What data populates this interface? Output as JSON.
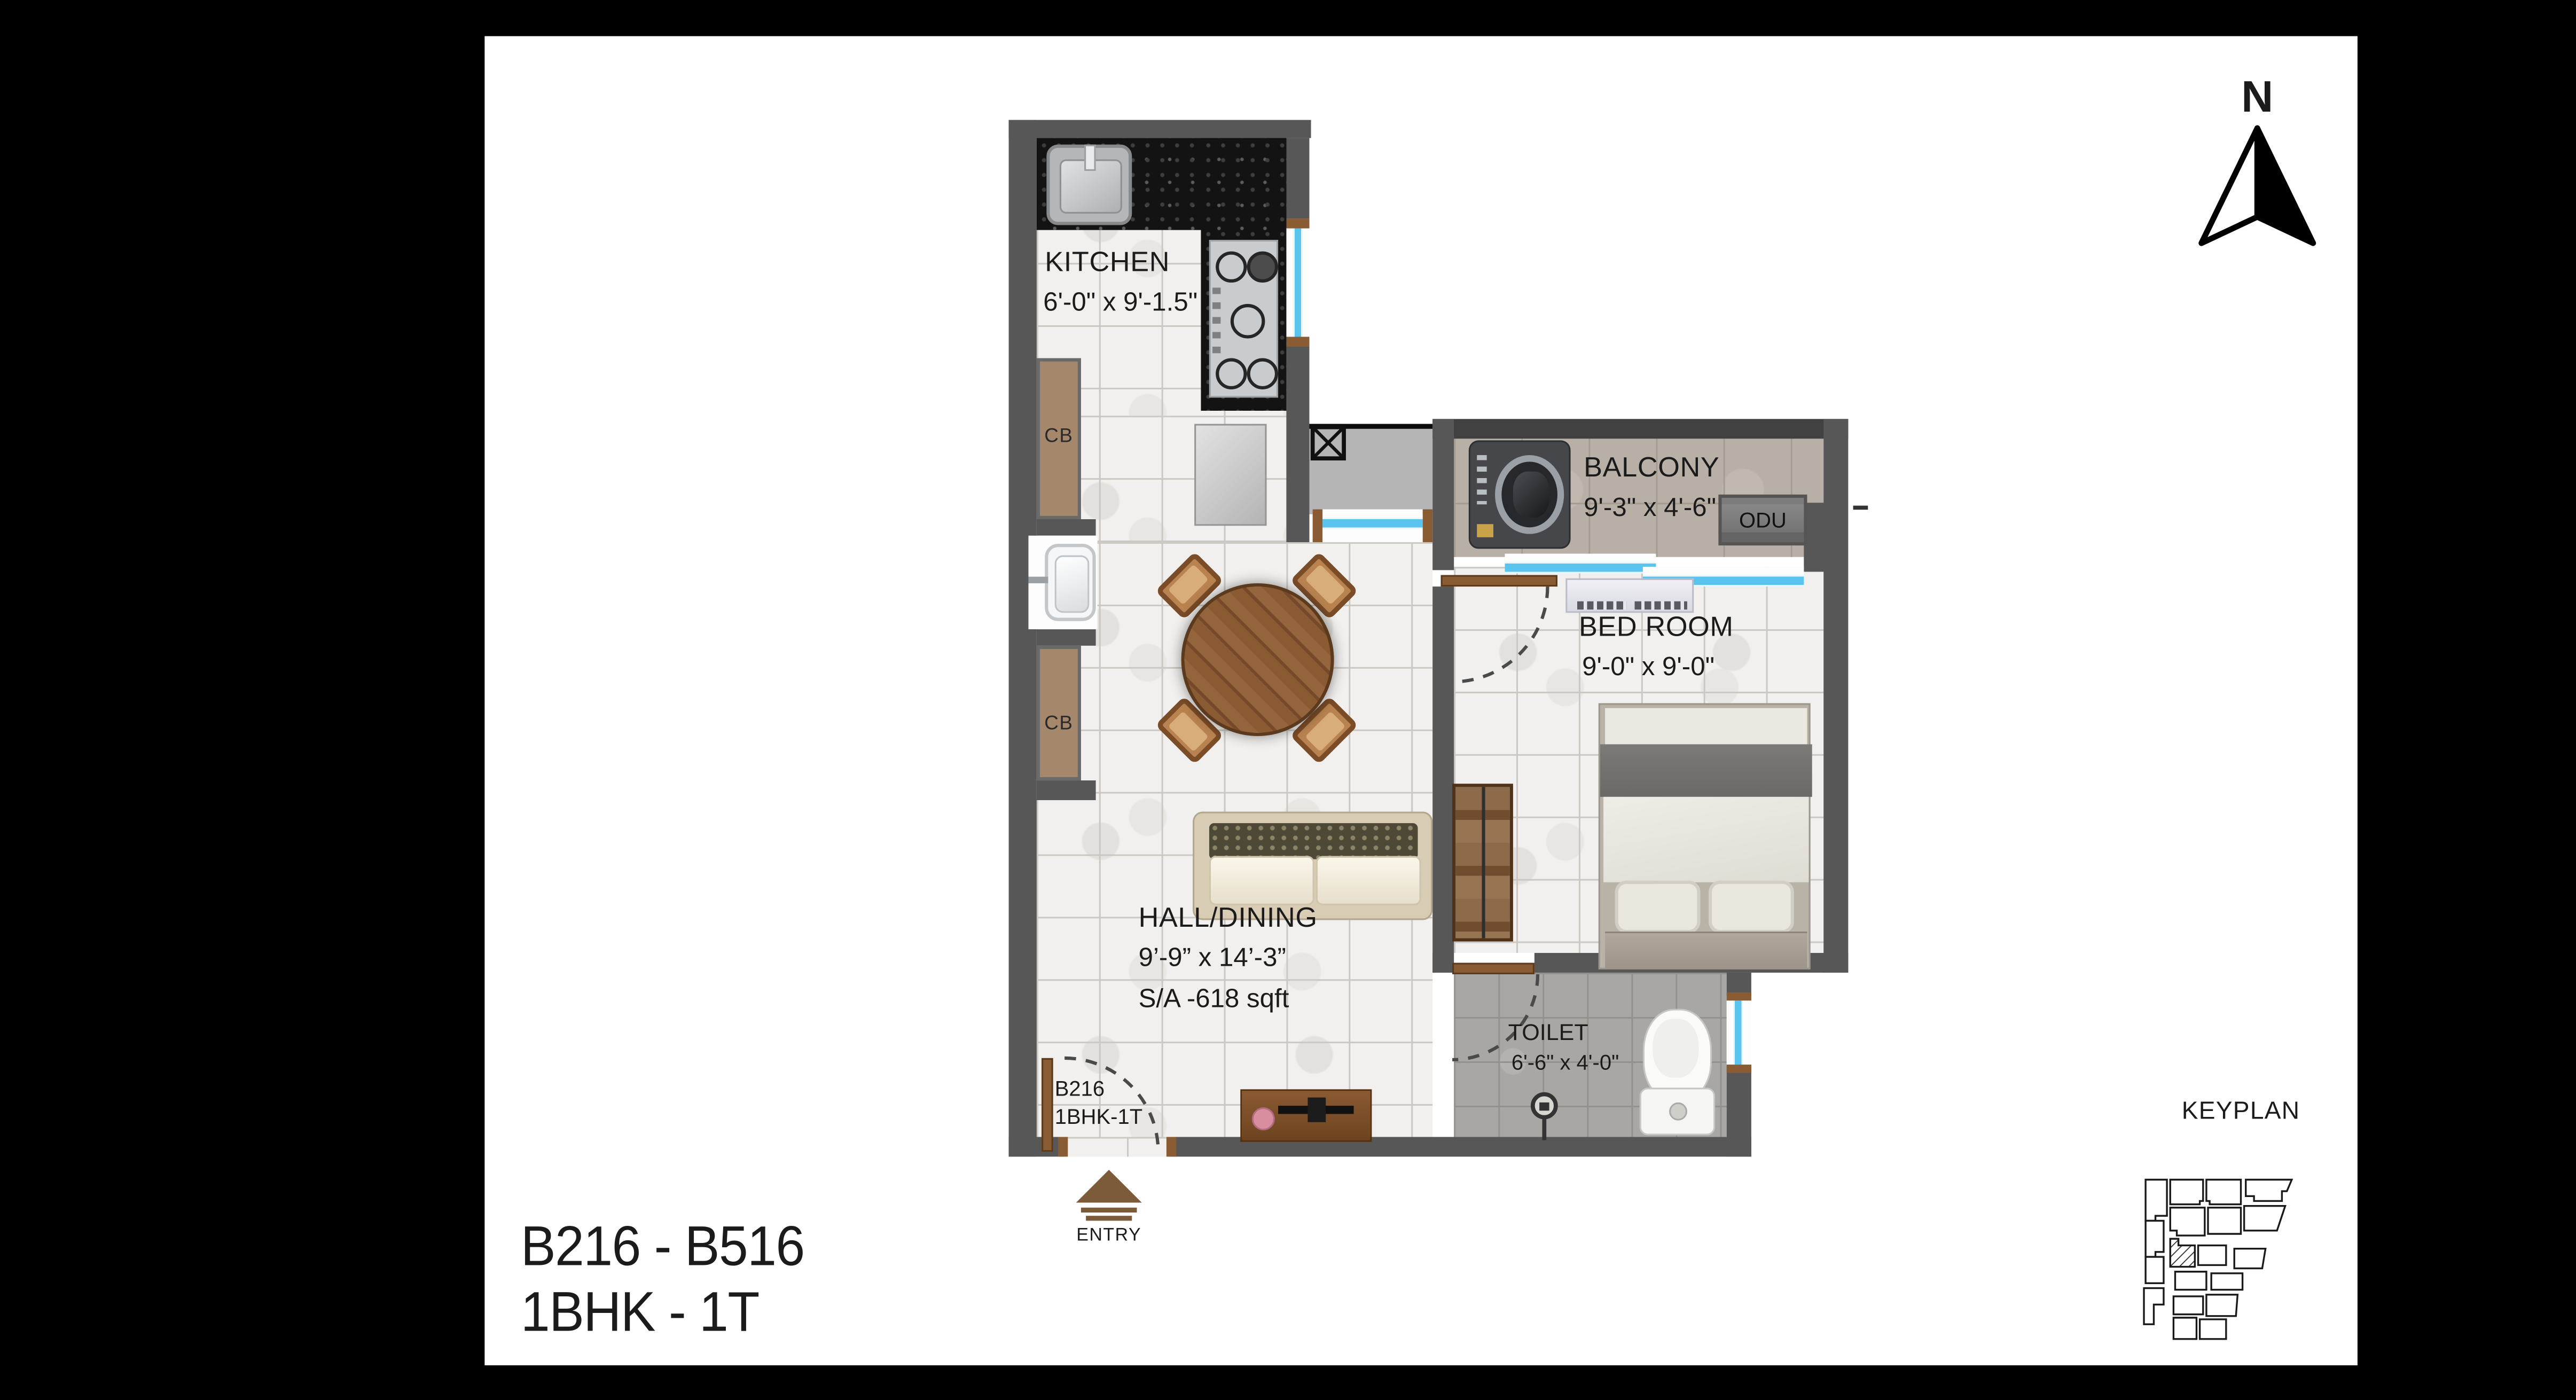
{
  "title": {
    "line1": "B216 - B516",
    "line2": "1BHK - 1T"
  },
  "compass": {
    "north_label": "N"
  },
  "keyplan": {
    "label": "KEYPLAN"
  },
  "entry": {
    "label": "ENTRY"
  },
  "unit_tag": {
    "line1": "B216",
    "line2": "1BHK-1T"
  },
  "rooms": {
    "kitchen": {
      "name": "KITCHEN",
      "dims": "6'-0\" x 9'-1.5\""
    },
    "balcony": {
      "name": "BALCONY",
      "dims": "9'-3\" x 4'-6\""
    },
    "bedroom": {
      "name": "BED ROOM",
      "dims": "9'-0\" x 9'-0\""
    },
    "hall": {
      "name": "HALL/DINING",
      "dims": "9’-9” x 14’-3”",
      "area": "S/A -618 sqft"
    },
    "toilet": {
      "name": "TOILET",
      "dims": "6'-6\" x 4'-0\""
    }
  },
  "labels": {
    "cb1": "CB",
    "cb2": "CB",
    "odu": "ODU"
  },
  "colors": {
    "background": "#000000",
    "sheet": "#ffffff",
    "wall": "#575757",
    "window_blue": "#5bc4ee",
    "wood": "#8a5c34",
    "cupboard": "#a5876b",
    "counter_granite": "#131313",
    "floor_hall": "#f1f0ee",
    "floor_balcony": "#b8b0a6",
    "floor_toilet": "#a8a7a3"
  }
}
